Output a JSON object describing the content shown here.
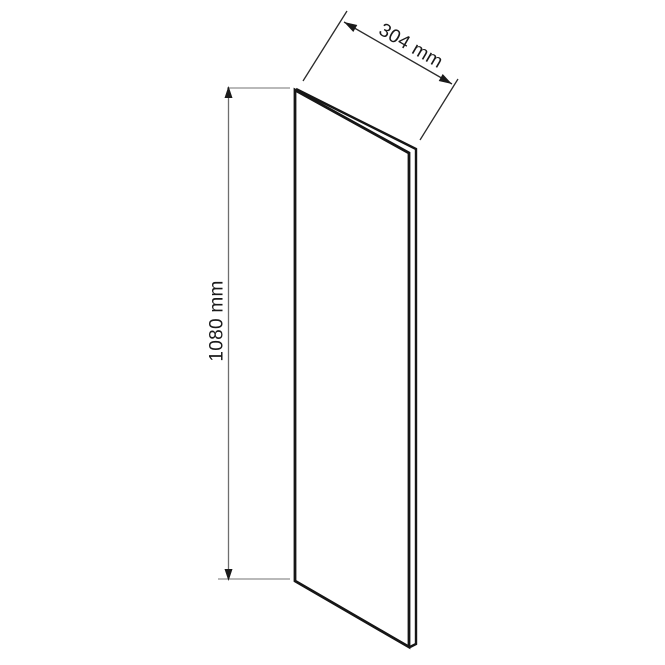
{
  "diagram": {
    "type": "furniture-panel-dimension-drawing",
    "width_dimension": {
      "label": "304 mm",
      "value_mm": 304,
      "unit": "mm"
    },
    "height_dimension": {
      "label": "1080 mm",
      "value_mm": 1080,
      "unit": "mm"
    }
  },
  "colors": {
    "background": "#ffffff",
    "panel_outline": "#161616",
    "panel_fill": "#ffffff",
    "dimension_line": "#6e6e6e",
    "extension_line": "#8f8f8f",
    "diagonal_dimension_line": "#2b2b2b",
    "arrowhead": "#1a1a1a",
    "label_text": "#1a1a1a"
  }
}
